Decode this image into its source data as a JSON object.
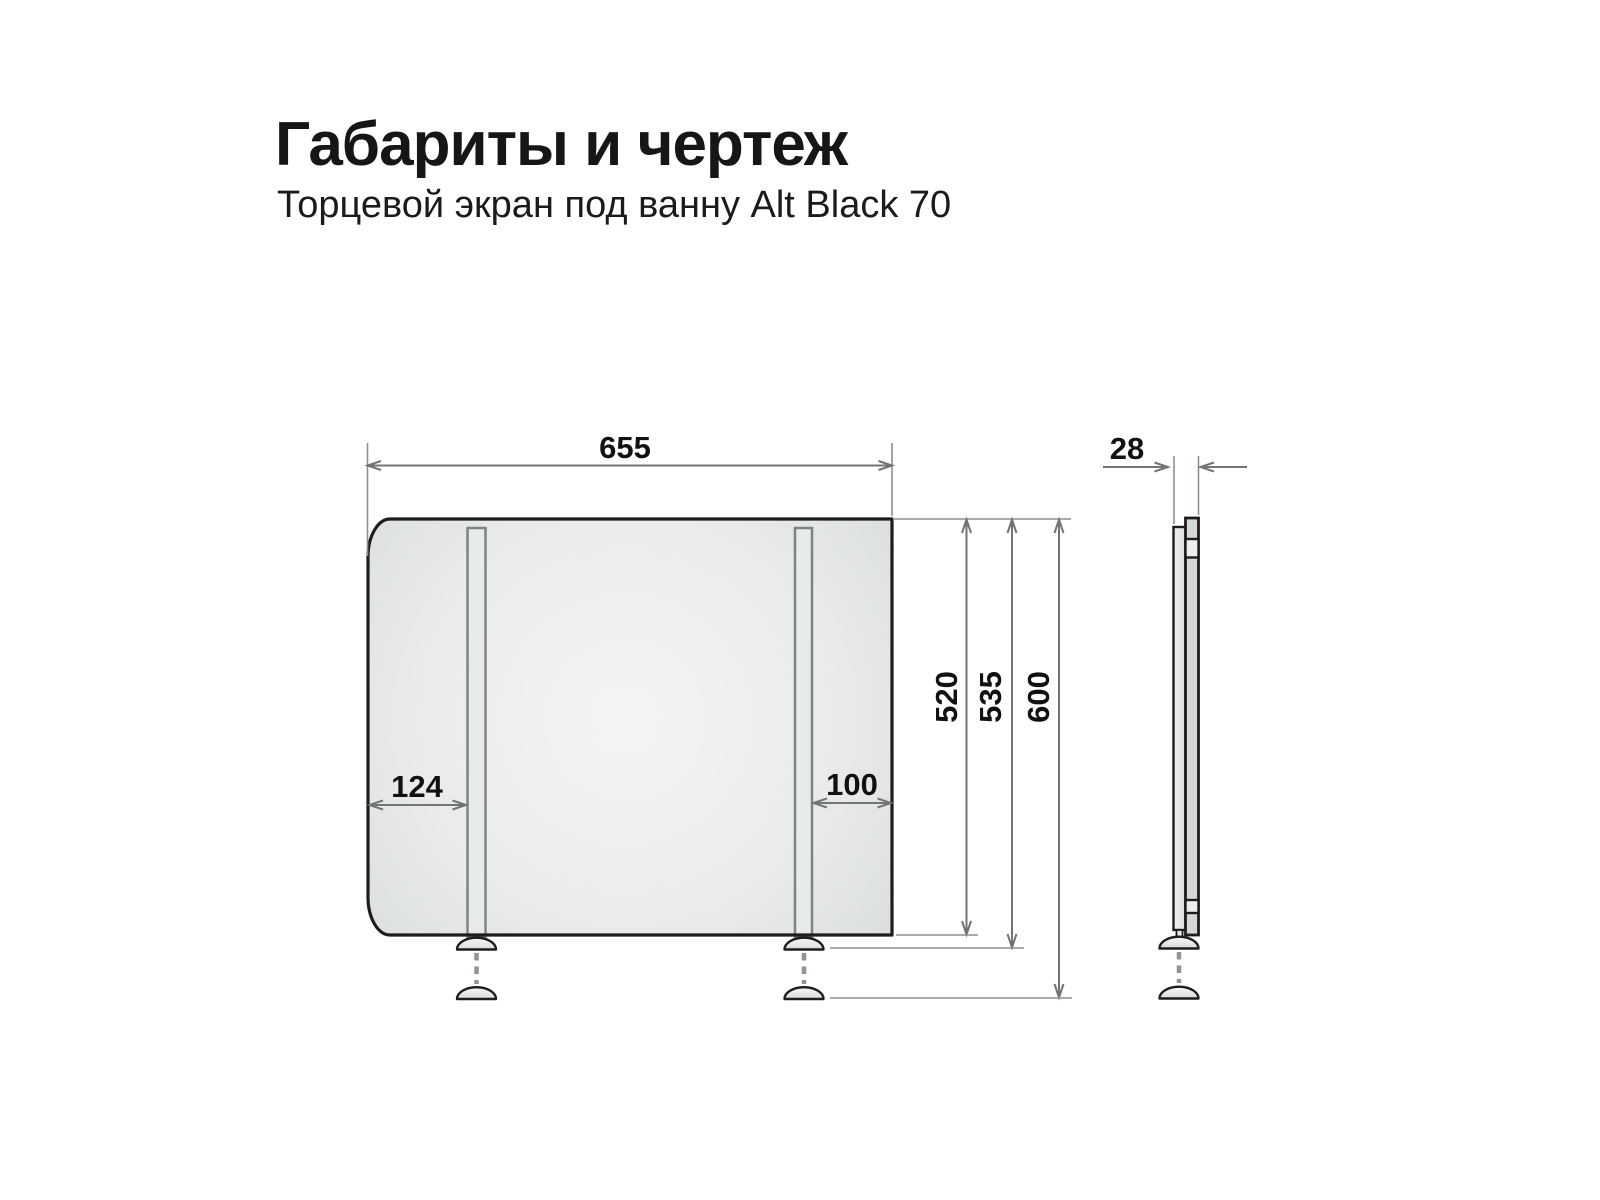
{
  "header": {
    "title": "Габариты и чертеж",
    "subtitle": "Торцевой экран под ванну Alt Black 70"
  },
  "drawing": {
    "front_view": {
      "overall_width": "655",
      "left_leg_offset": "124",
      "right_leg_offset": "100",
      "panel_height": "520",
      "height_with_foot": "535",
      "max_height": "600"
    },
    "side_view": {
      "thickness": "28"
    }
  },
  "colors": {
    "background": "#ffffff",
    "outline": "#1d1d1d",
    "panel_fill_center": "#f4f4f4",
    "panel_fill_edge": "#d2d5d6",
    "dimension_line": "#707477",
    "extension_line": "#8b9094",
    "text": "#111111"
  }
}
